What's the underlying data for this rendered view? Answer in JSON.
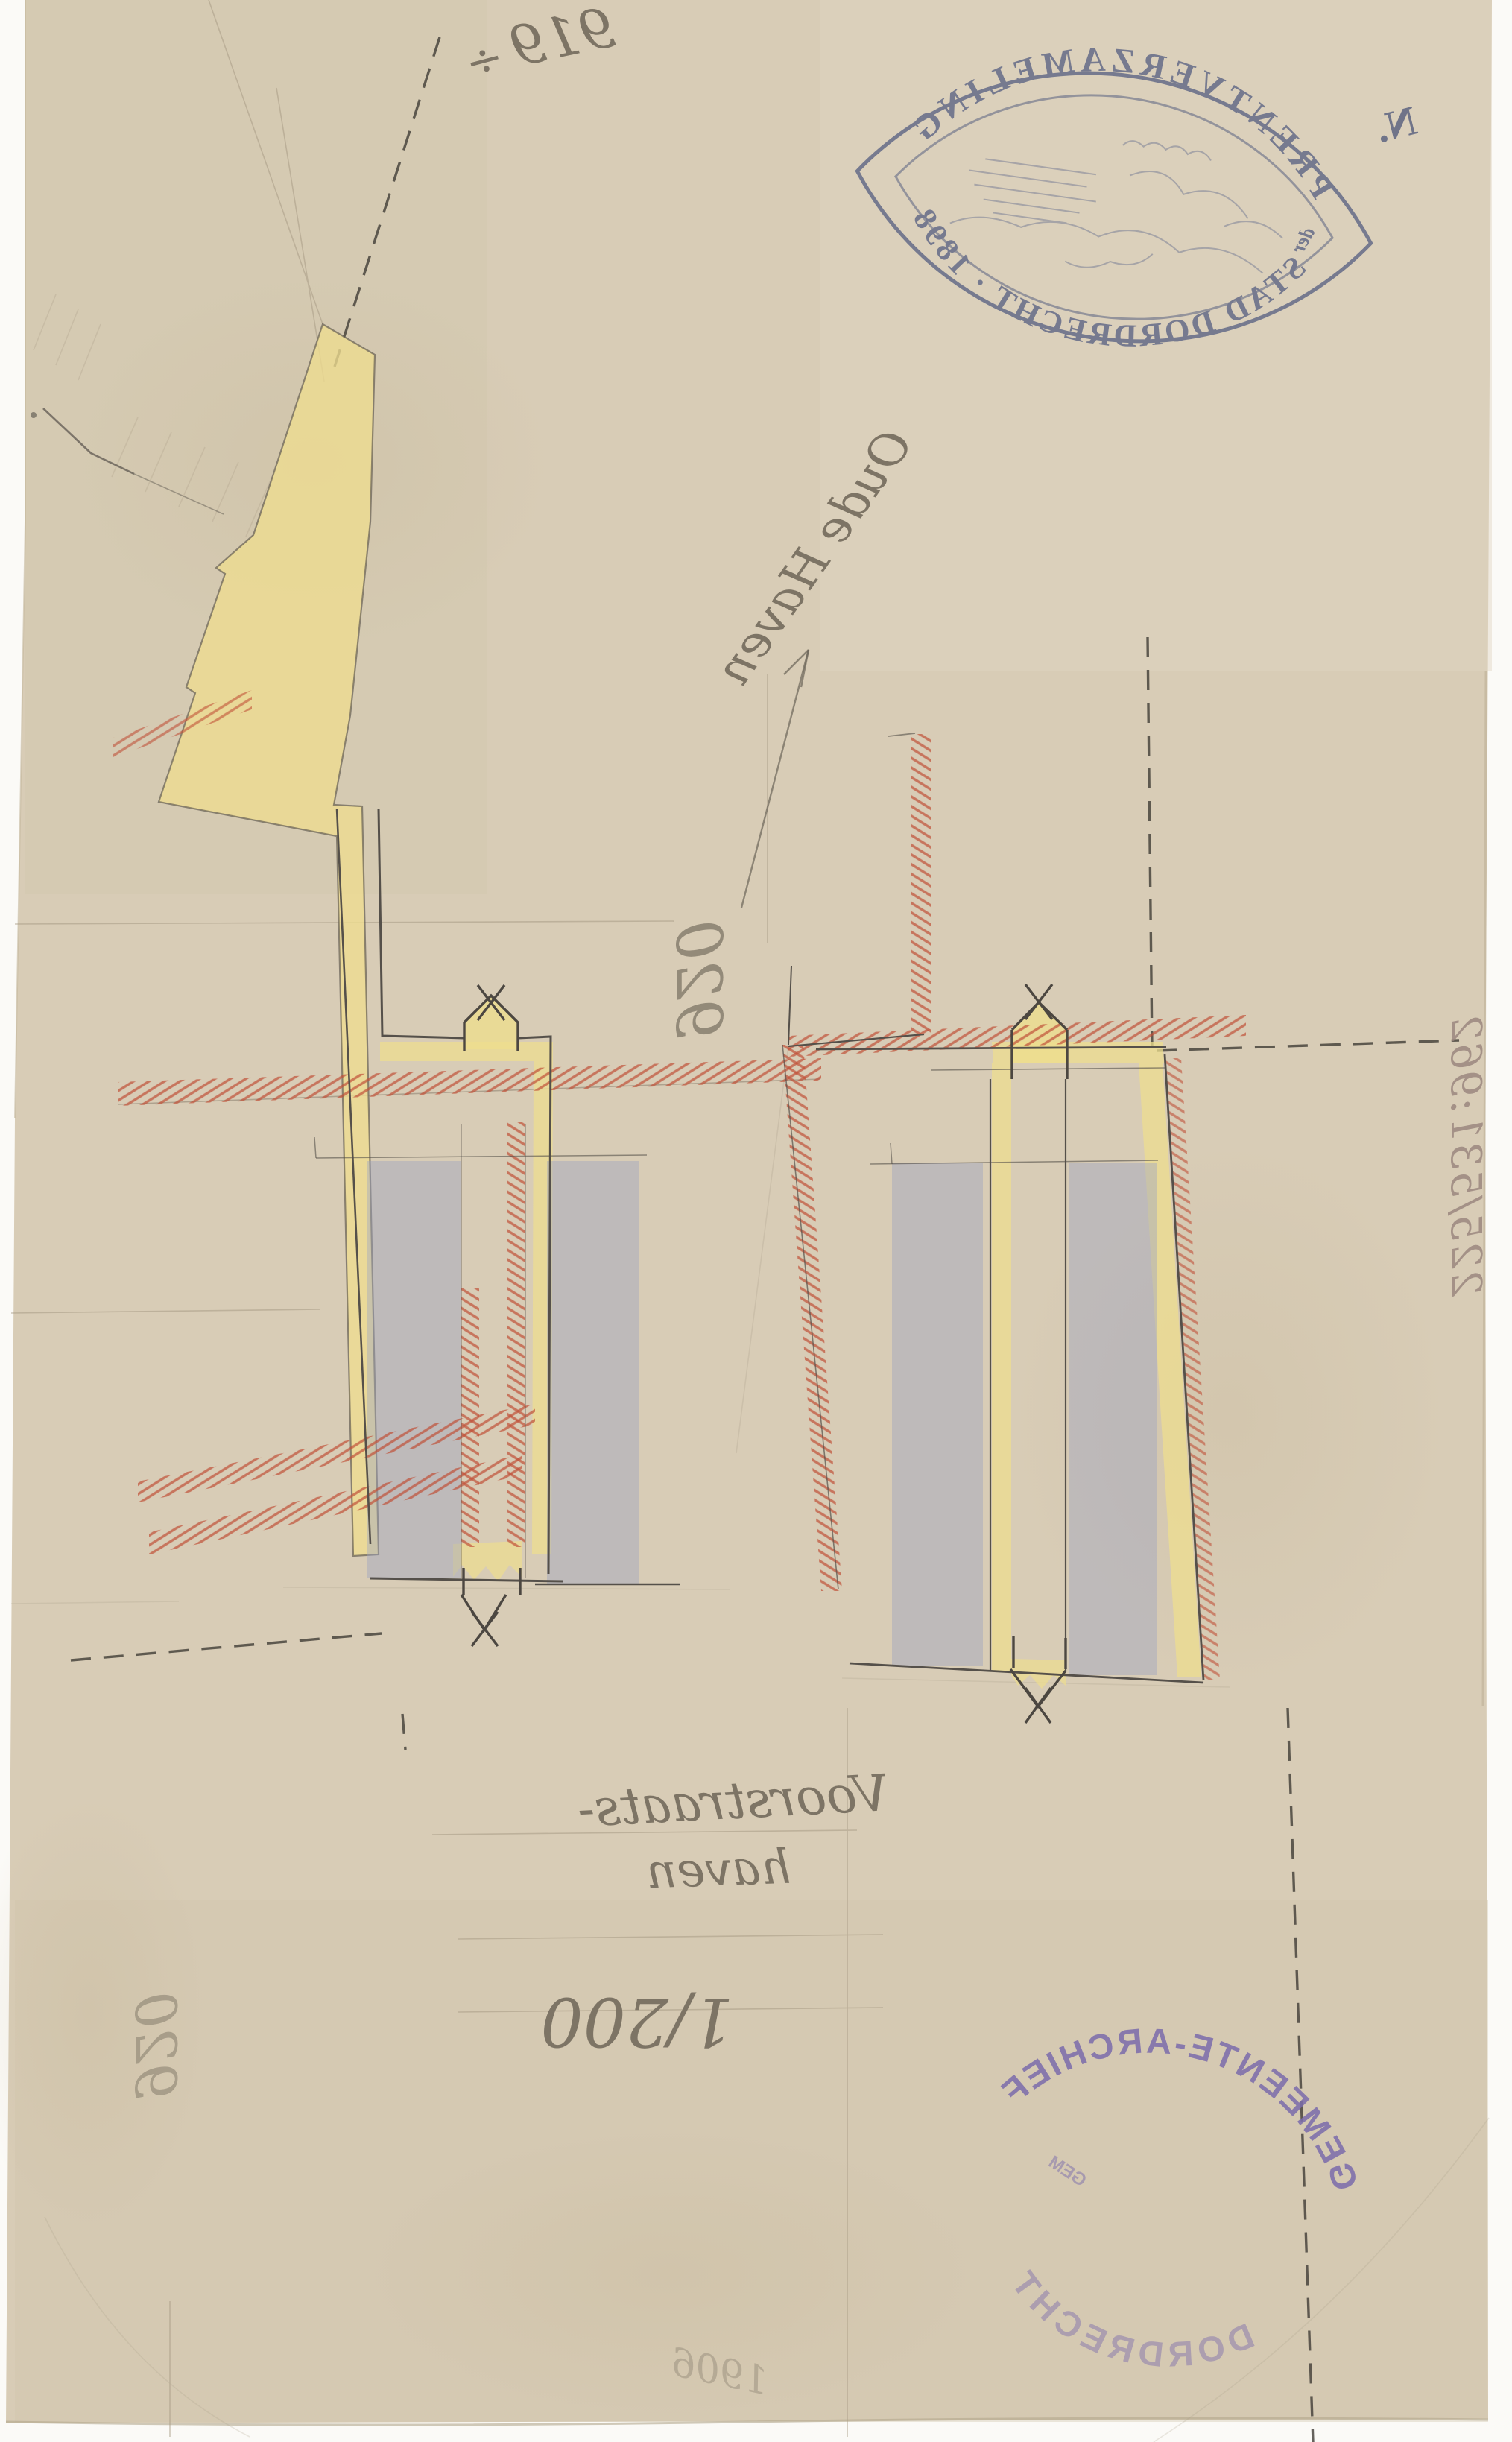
{
  "annotations": {
    "top_number": "919",
    "top_symbol": "÷",
    "n_mark": "N.",
    "oude_haven": "Oude Haven",
    "center_number": "920",
    "voorstraat_line1": "Voorstraats-",
    "voorstraat_line2": "haven",
    "scale_label": "1/200",
    "bottom_left_number": "920",
    "inventory_number": "225/531:962",
    "faint_year": "1906"
  },
  "stamps": {
    "print_collection": {
      "arc_top": "PRENTVERZAMELING",
      "small_word": "der",
      "arc_bottom": "STAD DORDRECHT",
      "year": " · 1898"
    },
    "municipal_archive": {
      "arc_top": "GEMEENTE-ARCHIEF",
      "arc_bottom": "DORDRECHT",
      "small_word": "GEM"
    }
  },
  "drawing": {
    "colors": {
      "paper": "#d8ccb6",
      "pencil": "#55504a",
      "pencil_faint": "#a89b85",
      "yellow": "#eedd8f",
      "blue": "#9aa2c2",
      "red_hatch": "#c05038",
      "stamp_blue": "#646b88",
      "stamp_purple": "#7b6cab",
      "dash": "#403c36"
    }
  }
}
